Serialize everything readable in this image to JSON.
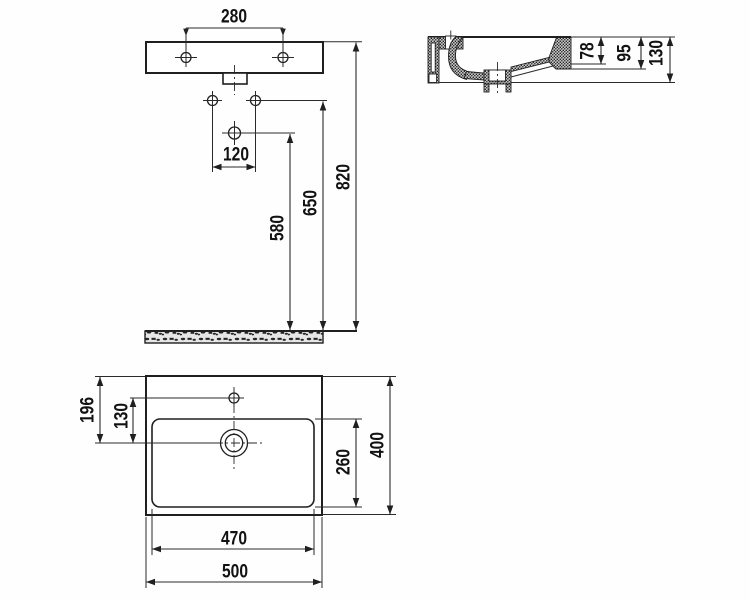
{
  "colors": {
    "line": "#1f1f1f",
    "paper": "#ffffff",
    "hatch_fill": "#c9c9c9",
    "floor_fill": "#e6e6e6"
  },
  "front_view": {
    "d280": "280",
    "d120": "120",
    "d580": "580",
    "d650": "650",
    "d820": "820"
  },
  "side_view": {
    "d78": "78",
    "d95": "95",
    "d130": "130"
  },
  "plan_view": {
    "d196": "196",
    "d130": "130",
    "d260": "260",
    "d400": "400",
    "d470": "470",
    "d500": "500"
  }
}
